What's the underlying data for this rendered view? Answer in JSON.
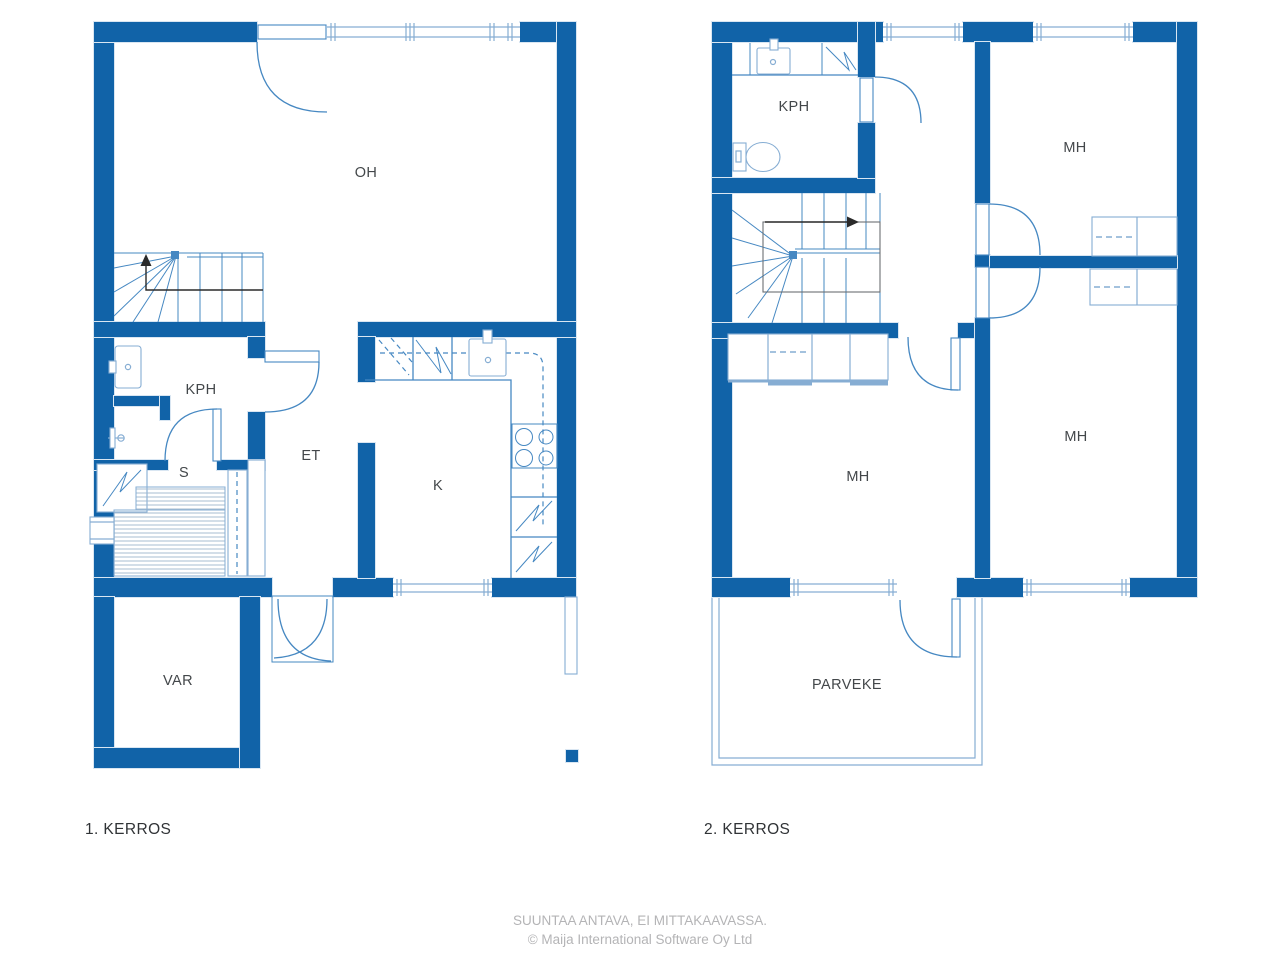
{
  "colors": {
    "wall": "#1163a8",
    "line": "#4688c2",
    "window_line": "#86add3",
    "light": "#d9e6f2",
    "slat": "#9db6cd",
    "label": "#43474a",
    "title": "#303336",
    "footer": "#b4b4b6",
    "walkline": "#2a2a2a",
    "void_outline": "#6b6f73"
  },
  "floor1": {
    "title": "1. KERROS",
    "rooms": {
      "oh": "OH",
      "kph": "KPH",
      "et": "ET",
      "s": "S",
      "k": "K",
      "var": "VAR"
    }
  },
  "floor2": {
    "title": "2. KERROS",
    "rooms": {
      "kph": "KPH",
      "mh_top": "MH",
      "mh_left": "MH",
      "mh_right": "MH",
      "parveke": "PARVEKE"
    }
  },
  "footer": {
    "line1": "SUUNTAA ANTAVA, EI MITTAKAAVASSA.",
    "line2": "© Maija International Software Oy Ltd"
  }
}
